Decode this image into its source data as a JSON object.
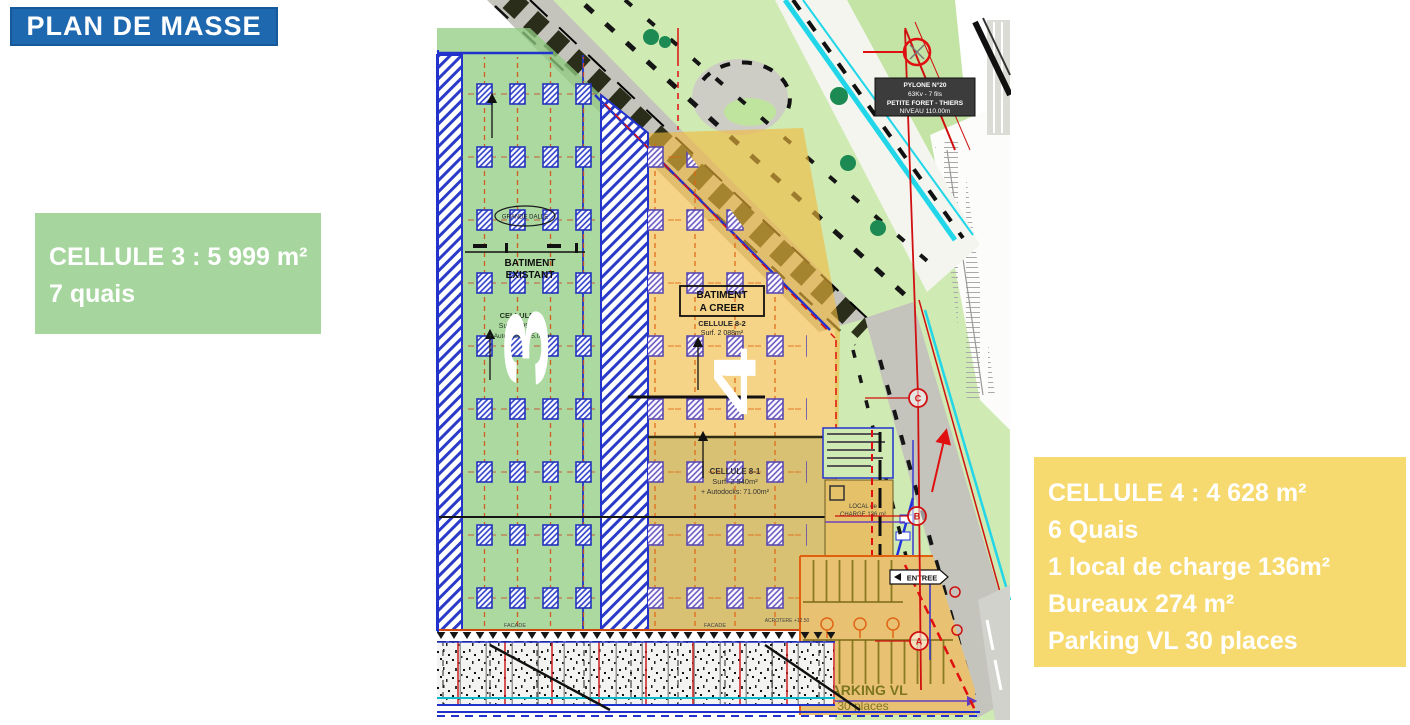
{
  "slide": {
    "title": "PLAN DE MASSE",
    "background": "#ffffff"
  },
  "cell3_box": {
    "title": "CELLULE 3 : 5 999 m²",
    "subtitle": "7 quais",
    "color": "#a6d69e"
  },
  "cell4_box": {
    "lines": [
      "CELLULE 4 : 4 628 m²",
      "6 Quais",
      "1 local de charge 136m²",
      "Bureaux 274 m²",
      "Parking VL 30 places"
    ],
    "color": "#f7da6f"
  },
  "plan": {
    "numerals": {
      "cell3": "3",
      "cell4": "4"
    },
    "labels": {
      "batiment_existant_l1": "BATIMENT",
      "batiment_existant_l2": "EXISTANT",
      "batiment_a_creer_l1": "BATIMENT",
      "batiment_a_creer_l2": "A CREER",
      "grande_dalle": "GRANDE DALLE",
      "cellule7_name": "CELLULE 7",
      "cellule7_surface": "Surf. 5 999m²",
      "cellule7_autodocks": "+ Autodocks: 85.00m²",
      "cellule82_name": "CELLULE 8-2",
      "cellule82_surface": "Surf. 2 088m²",
      "cellule81_name": "CELLULE 8-1",
      "cellule81_surface": "Surf. 2 540m²",
      "cellule81_autodocks": "+ Autodocks: 71.00m²",
      "local_charge_l1": "LOCAL de",
      "local_charge_l2": "CHARGE 136 m²",
      "parking_l1": "PARKING VL",
      "parking_l2": "30 places",
      "entree": "ENTREE",
      "facade_left": "FACADE",
      "facade_right": "FACADE",
      "acrotere": "ACROTERE +12.50"
    },
    "pylone_label": {
      "l1": "PYLONE N°20",
      "l2": "63Kv - 7 fils",
      "l3": "PETITE FORET - THIERS",
      "l4": "NIVEAU 110.00m"
    },
    "survey_markers": {
      "a": "A",
      "b": "B",
      "c": "C"
    }
  },
  "colors": {
    "title_blue": "#1e68b0",
    "cell3_green": "#a6d69e",
    "cell4_yellow": "#f7da6f",
    "plan_zone_green": "#b7dcaa",
    "plan_zone_yellow": "#f2c85c",
    "hatch_blue": "#2a3bc8",
    "column_purple": "#6a55c0",
    "road_gray": "#c4c4bc",
    "verge_green": "#cfeab2",
    "accent_red": "#e01010",
    "cyan_line": "#20d6e8"
  }
}
